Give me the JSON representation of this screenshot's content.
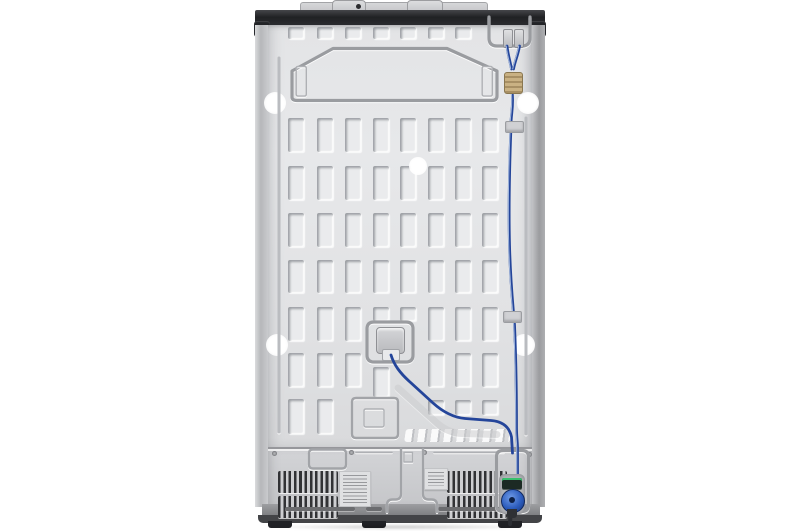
{
  "scene": {
    "subject": "rear-view-of-side-by-side-refrigerator",
    "background": "studio-white"
  },
  "palette": {
    "background": "#ffffff",
    "panel": "#e3e4e6",
    "top_strip": "#202124",
    "cover": "#cbccce",
    "vent_slat": "#313235",
    "emboss_line": "#a2a4a8",
    "tube_blue": "#24459a",
    "brass_coupler": "#b29a70",
    "filter_valve_blue": "#2c5cbd",
    "filter_cap_green": "#38c06d",
    "base": "#8e8f92",
    "foot": "#212226"
  },
  "panel_grid": {
    "slot_width": 16,
    "columns_x": [
      288,
      317,
      345,
      373,
      400,
      428,
      455,
      482
    ],
    "rows": [
      {
        "y": 27,
        "h": 12,
        "cols": [
          0,
          1,
          2,
          3,
          4,
          5,
          6
        ]
      },
      {
        "y": 118,
        "h": 34,
        "cols": [
          0,
          1,
          2,
          3,
          4,
          5,
          6,
          7
        ]
      },
      {
        "y": 166,
        "h": 34,
        "cols": [
          0,
          1,
          2,
          3,
          4,
          5,
          6,
          7
        ]
      },
      {
        "y": 213,
        "h": 34,
        "cols": [
          0,
          1,
          2,
          3,
          4,
          5,
          6,
          7
        ]
      },
      {
        "y": 260,
        "h": 33,
        "cols": [
          0,
          1,
          2,
          3,
          4,
          5,
          6,
          7
        ]
      },
      {
        "y": 307,
        "h": 34,
        "cols": [
          0,
          1,
          2,
          5,
          6,
          7
        ]
      },
      {
        "y": 307,
        "h": 14,
        "cols": [
          3,
          4
        ]
      },
      {
        "y": 353,
        "h": 34,
        "cols": [
          0,
          1,
          2,
          5,
          6,
          7
        ]
      },
      {
        "y": 367,
        "h": 30,
        "cols": [
          3
        ]
      },
      {
        "y": 399,
        "h": 35,
        "cols": [
          0,
          1
        ]
      },
      {
        "y": 400,
        "h": 15,
        "cols": [
          5,
          6,
          7
        ]
      }
    ]
  },
  "holes": [
    {
      "x": 275,
      "y": 103,
      "r": 11
    },
    {
      "x": 528,
      "y": 103,
      "r": 11
    },
    {
      "x": 418,
      "y": 166,
      "r": 9
    },
    {
      "x": 277,
      "y": 345,
      "r": 11
    },
    {
      "x": 524,
      "y": 345,
      "r": 11
    }
  ],
  "emboss_paths": [
    {
      "d": "M292,97 L292,71 L333,48.5 L447,48.5 L497,71 L497,96 Q497,100.5 492,100.5 L297,100.5 Q292,100.5 292,97 Z",
      "cls": "em em-heavy"
    },
    {
      "d": "M298,66.5 h6.5 q1.8,0 1.8,1.8 v26 q0,1.8 -1.8,1.8 h-6.5 q-1.8,0 -1.8,-1.8 v-26 q0,-1.8 1.8,-1.8 z",
      "cls": "em em-thin"
    },
    {
      "d": "M484,66.5 h6.5 q1.8,0 1.8,1.8 v26 q0,1.8 -1.8,1.8 h-6.5 q-1.8,0 -1.8,-1.8 v-26 q0,-1.8 1.8,-1.8 z",
      "cls": "em em-thin"
    },
    {
      "d": "M489,17 v21 q0,8 8,8 h25 q8,0 8,-8 v-21",
      "cls": "em em-heavy"
    },
    {
      "d": "M279,58 V432",
      "cls": "em groove"
    },
    {
      "d": "M526,118 V434",
      "cls": "em groove"
    },
    {
      "d": "M398,388 L438,424 Q449,433 462,433.5 L497,434.5",
      "cls": "em channel"
    },
    {
      "d": "M374,322 h32 q7,0 7,7 v26 q0,7 -7,7 h-32 q-7,0 -7,-7 v-26 q0,-7 7,-7 z",
      "cls": "em em-heavy"
    },
    {
      "d": "M356,398 h38 q4,0 4,4 v32 q0,4 -4,4 h-38 q-4,0 -4,-4 v-32 q0,-4 4,-4 z",
      "cls": "em"
    },
    {
      "d": "M366,409 h16 q2,0 2,2 v14 q0,2 -2,2 h-16 q-2,0 -2,-2 v-14 q0,-2 2,-2 z",
      "cls": "em em-thin"
    },
    {
      "d": "M313,449.5 h29 q4,0 4,4 v11 q0,4 -4,4 h-29 q-4,0 -4,-4 v-11 q0,-4 4,-4 z",
      "cls": "em"
    },
    {
      "d": "M356,452.5 h36",
      "cls": "em em-thin"
    },
    {
      "d": "M434,452.5 h70",
      "cls": "em em-thin"
    },
    {
      "d": "M401,449 L401,494 Q401,499.5 395.5,499.5 L392.5,499.5 Q387,499.5 387,505 L387,512",
      "cls": "em"
    },
    {
      "d": "M423,449 L423,494 Q423,499.5 428.5,499.5 L431.5,499.5 Q437,499.5 437,505 L437,512",
      "cls": "em"
    },
    {
      "d": "M404,452.5 h8.5 v9.5 h-8.5 z",
      "cls": "em em-thin"
    },
    {
      "d": "M503,450.5 h19 q6.5,0 6.5,6.5 v48 q0,6.5 -6.5,6.5 h-19 q-6.5,0 -6.5,-6.5 v-48 q0,-6.5 6.5,-6.5 z",
      "cls": "em em-heavy"
    }
  ],
  "tubes": {
    "main": "M507,46 C508,55 510,61 511.5,69 M519.5,46 C518,55 515,61 513.5,69 M512,91 C514,106 510.5,116 511,126 C509.5,165 508.5,205 509.5,245 C510.5,285 513,305 514.5,325 C516,360 516.5,400 516.5,428 C516.5,437 517.5,442 517.5,448 L517.5,480",
    "branch": "M391,355 C394,365 400,373 410,382 L433,403 C443,412 453.5,417.5 465,418.5 L491,420.5 C503,421.5 509.5,427 511.5,437 L512.5,453",
    "drain": "M511,506 L510,524"
  },
  "base_grooves": [
    {
      "x": 285,
      "w": 70
    },
    {
      "x": 366,
      "w": 16
    },
    {
      "x": 438,
      "w": 70
    }
  ],
  "screws": [
    {
      "x": 272,
      "y": 451
    },
    {
      "x": 349,
      "y": 450
    },
    {
      "x": 422,
      "y": 450
    },
    {
      "x": 527,
      "y": 452
    }
  ]
}
